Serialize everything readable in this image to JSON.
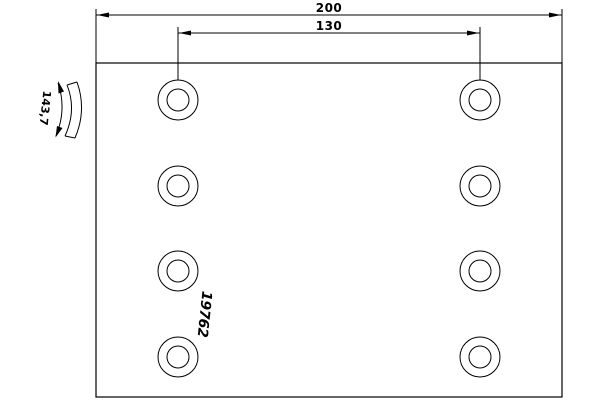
{
  "drawing": {
    "type": "brake-lining-technical-drawing",
    "part_number": "19762",
    "dimensions": {
      "overall_length": "200",
      "hole_spacing": "130",
      "arc_width": "143,7"
    },
    "holes": {
      "count": 8,
      "columns": 2,
      "rows": 4
    },
    "colors": {
      "line": "#000000",
      "background": "#ffffff"
    }
  }
}
